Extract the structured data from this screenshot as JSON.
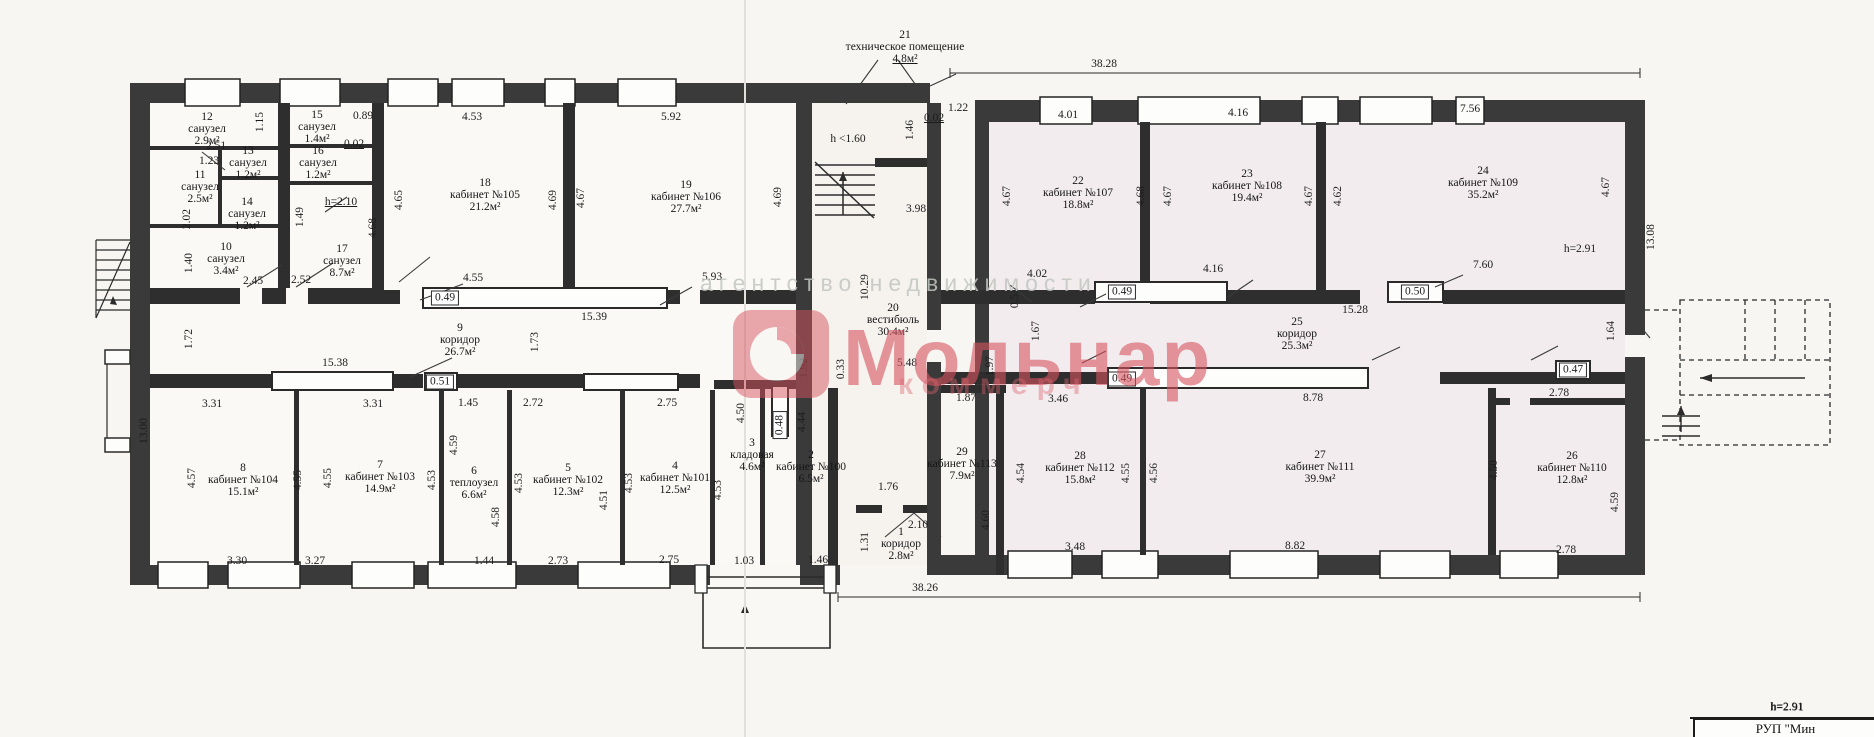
{
  "watermark": {
    "brand": "Мольнар",
    "tagline": "агентство недвижимости",
    "sub": "коммерч",
    "accent_color": "#d85560",
    "gray_color": "#c2c6c1"
  },
  "title_block": {
    "height_note": "h=2.91",
    "org": "РУП \"Мин"
  },
  "rooms": [
    {
      "n": "1",
      "name": "коридор",
      "area": "2.8м²",
      "x": 901,
      "y": 544
    },
    {
      "n": "2",
      "name": "кабинет №100",
      "area": "6.5м²",
      "x": 811,
      "y": 467
    },
    {
      "n": "3",
      "name": "кладовая",
      "area": "4.6м²",
      "x": 752,
      "y": 455
    },
    {
      "n": "4",
      "name": "кабинет №101",
      "area": "12.5м²",
      "x": 675,
      "y": 478
    },
    {
      "n": "5",
      "name": "кабинет №102",
      "area": "12.3м²",
      "x": 568,
      "y": 480
    },
    {
      "n": "6",
      "name": "теплоузел",
      "area": "6.6м²",
      "x": 474,
      "y": 483
    },
    {
      "n": "7",
      "name": "кабинет №103",
      "area": "14.9м²",
      "x": 380,
      "y": 477
    },
    {
      "n": "8",
      "name": "кабинет №104",
      "area": "15.1м²",
      "x": 243,
      "y": 480
    },
    {
      "n": "9",
      "name": "коридор",
      "area": "26.7м²",
      "x": 460,
      "y": 340
    },
    {
      "n": "10",
      "name": "санузел",
      "area": "3.4м²",
      "x": 226,
      "y": 259
    },
    {
      "n": "11",
      "name": "санузел",
      "area": "2.5м²",
      "x": 200,
      "y": 187
    },
    {
      "n": "12",
      "name": "санузел",
      "area": "2.9м²",
      "x": 207,
      "y": 129
    },
    {
      "n": "13",
      "name": "санузел",
      "area": "1.2м²",
      "x": 248,
      "y": 163
    },
    {
      "n": "14",
      "name": "санузел",
      "area": "1.2м²",
      "x": 247,
      "y": 214
    },
    {
      "n": "15",
      "name": "санузел",
      "area": "1.4м²",
      "x": 317,
      "y": 127
    },
    {
      "n": "16",
      "name": "санузел",
      "area": "1.2м²",
      "x": 318,
      "y": 163
    },
    {
      "n": "17",
      "name": "санузел",
      "area": "8.7м²",
      "x": 342,
      "y": 261
    },
    {
      "n": "18",
      "name": "кабинет №105",
      "area": "21.2м²",
      "x": 485,
      "y": 195
    },
    {
      "n": "19",
      "name": "кабинет №106",
      "area": "27.7м²",
      "x": 686,
      "y": 197
    },
    {
      "n": "20",
      "name": "вестибюль",
      "area": "30.4м²",
      "x": 893,
      "y": 320
    },
    {
      "n": "21",
      "name": "техническое помещение",
      "area": "4.8м²",
      "x": 905,
      "y": 47,
      "u": true
    },
    {
      "n": "22",
      "name": "кабинет №107",
      "area": "18.8м²",
      "x": 1078,
      "y": 193
    },
    {
      "n": "23",
      "name": "кабинет №108",
      "area": "19.4м²",
      "x": 1247,
      "y": 186
    },
    {
      "n": "24",
      "name": "кабинет №109",
      "area": "35.2м²",
      "x": 1483,
      "y": 183
    },
    {
      "n": "25",
      "name": "коридор",
      "area": "25.3м²",
      "x": 1297,
      "y": 334
    },
    {
      "n": "26",
      "name": "кабинет №110",
      "area": "12.8м²",
      "x": 1572,
      "y": 468
    },
    {
      "n": "27",
      "name": "кабинет №111",
      "area": "39.9м²",
      "x": 1320,
      "y": 467
    },
    {
      "n": "28",
      "name": "кабинет №112",
      "area": "15.8м²",
      "x": 1080,
      "y": 468
    },
    {
      "n": "29",
      "name": "кабинет №113",
      "area": "7.9м²",
      "x": 962,
      "y": 464
    }
  ],
  "dims": [
    {
      "t": "2.51",
      "x": 216,
      "y": 146
    },
    {
      "t": "1.23",
      "x": 209,
      "y": 161
    },
    {
      "t": "2.45",
      "x": 253,
      "y": 281
    },
    {
      "t": "2.52",
      "x": 301,
      "y": 280
    },
    {
      "t": "0.89",
      "x": 363,
      "y": 116
    },
    {
      "t": "0.02",
      "x": 354,
      "y": 144,
      "u": true
    },
    {
      "t": "h=2.10",
      "x": 341,
      "y": 202,
      "u": true
    },
    {
      "t": "4.53",
      "x": 472,
      "y": 117
    },
    {
      "t": "4.55",
      "x": 473,
      "y": 278
    },
    {
      "t": "0.49",
      "x": 445,
      "y": 298,
      "box": true
    },
    {
      "t": "15.39",
      "x": 594,
      "y": 317
    },
    {
      "t": "5.92",
      "x": 671,
      "y": 117
    },
    {
      "t": "5.93",
      "x": 712,
      "y": 277
    },
    {
      "t": "h <1.60",
      "x": 848,
      "y": 139
    },
    {
      "t": "0.02",
      "x": 934,
      "y": 118,
      "u": true
    },
    {
      "t": "1.22",
      "x": 958,
      "y": 108
    },
    {
      "t": "3.98",
      "x": 916,
      "y": 209
    },
    {
      "t": "38.28",
      "x": 1104,
      "y": 64
    },
    {
      "t": "4.01",
      "x": 1068,
      "y": 115
    },
    {
      "t": "4.16",
      "x": 1238,
      "y": 113
    },
    {
      "t": "7.56",
      "x": 1470,
      "y": 109
    },
    {
      "t": "h=2.91",
      "x": 1580,
      "y": 249
    },
    {
      "t": "7.60",
      "x": 1483,
      "y": 265
    },
    {
      "t": "0.50",
      "x": 1415,
      "y": 292,
      "box": true
    },
    {
      "t": "4.02",
      "x": 1037,
      "y": 274
    },
    {
      "t": "15.28",
      "x": 1355,
      "y": 310
    },
    {
      "t": "4.16",
      "x": 1213,
      "y": 269
    },
    {
      "t": "0.49",
      "x": 1122,
      "y": 292,
      "box": true
    },
    {
      "t": "15.38",
      "x": 335,
      "y": 363
    },
    {
      "t": "0.51",
      "x": 440,
      "y": 382,
      "box": true
    },
    {
      "t": "3.31",
      "x": 212,
      "y": 404
    },
    {
      "t": "3.31",
      "x": 373,
      "y": 404
    },
    {
      "t": "1.45",
      "x": 468,
      "y": 403
    },
    {
      "t": "2.72",
      "x": 533,
      "y": 403
    },
    {
      "t": "2.75",
      "x": 667,
      "y": 403
    },
    {
      "t": "3.30",
      "x": 237,
      "y": 561
    },
    {
      "t": "3.27",
      "x": 315,
      "y": 561
    },
    {
      "t": "1.44",
      "x": 484,
      "y": 561
    },
    {
      "t": "2.73",
      "x": 558,
      "y": 561
    },
    {
      "t": "2.75",
      "x": 669,
      "y": 560
    },
    {
      "t": "1.03",
      "x": 744,
      "y": 561
    },
    {
      "t": "1.46",
      "x": 818,
      "y": 560
    },
    {
      "t": "1.76",
      "x": 888,
      "y": 487
    },
    {
      "t": "2.10",
      "x": 918,
      "y": 525
    },
    {
      "t": "5.48",
      "x": 907,
      "y": 363
    },
    {
      "t": "1.87",
      "x": 966,
      "y": 398
    },
    {
      "t": "3.46",
      "x": 1058,
      "y": 399
    },
    {
      "t": "0.49",
      "x": 1122,
      "y": 379,
      "box": true
    },
    {
      "t": "8.78",
      "x": 1313,
      "y": 398
    },
    {
      "t": "3.48",
      "x": 1075,
      "y": 547
    },
    {
      "t": "8.82",
      "x": 1295,
      "y": 546
    },
    {
      "t": "2.78",
      "x": 1559,
      "y": 393
    },
    {
      "t": "0.47",
      "x": 1573,
      "y": 370,
      "box": true
    },
    {
      "t": "2.78",
      "x": 1566,
      "y": 550
    },
    {
      "t": "38.26",
      "x": 925,
      "y": 588
    },
    {
      "t": "h=2.91",
      "x": 1787,
      "y": 707
    },
    {
      "t": "1.15",
      "x": 260,
      "y": 122,
      "v": true
    },
    {
      "t": "2.02",
      "x": 187,
      "y": 219,
      "v": true
    },
    {
      "t": "1.49",
      "x": 300,
      "y": 217,
      "v": true
    },
    {
      "t": "1.40",
      "x": 189,
      "y": 263,
      "v": true
    },
    {
      "t": "4.68",
      "x": 373,
      "y": 228,
      "v": true
    },
    {
      "t": "4.65",
      "x": 399,
      "y": 200,
      "v": true
    },
    {
      "t": "4.69",
      "x": 553,
      "y": 200,
      "v": true
    },
    {
      "t": "4.67",
      "x": 581,
      "y": 198,
      "v": true
    },
    {
      "t": "4.69",
      "x": 778,
      "y": 197,
      "v": true
    },
    {
      "t": "1.46",
      "x": 910,
      "y": 130,
      "v": true
    },
    {
      "t": "10.29",
      "x": 865,
      "y": 287,
      "v": true
    },
    {
      "t": "1.72",
      "x": 189,
      "y": 339,
      "v": true
    },
    {
      "t": "13.00",
      "x": 144,
      "y": 431,
      "v": true
    },
    {
      "t": "1.73",
      "x": 535,
      "y": 342,
      "v": true
    },
    {
      "t": "4.57",
      "x": 192,
      "y": 478,
      "v": true
    },
    {
      "t": "4.55",
      "x": 298,
      "y": 480,
      "v": true
    },
    {
      "t": "4.55",
      "x": 328,
      "y": 478,
      "v": true
    },
    {
      "t": "4.53",
      "x": 432,
      "y": 480,
      "v": true
    },
    {
      "t": "4.59",
      "x": 454,
      "y": 445,
      "v": true
    },
    {
      "t": "4.53",
      "x": 519,
      "y": 483,
      "v": true
    },
    {
      "t": "4.51",
      "x": 604,
      "y": 500,
      "v": true
    },
    {
      "t": "4.53",
      "x": 629,
      "y": 483,
      "v": true
    },
    {
      "t": "4.58",
      "x": 496,
      "y": 517,
      "v": true
    },
    {
      "t": "4.50",
      "x": 741,
      "y": 413,
      "v": true
    },
    {
      "t": "0.48",
      "x": 780,
      "y": 425,
      "v": true,
      "box": true
    },
    {
      "t": "4.44",
      "x": 802,
      "y": 422,
      "v": true
    },
    {
      "t": "4.53",
      "x": 718,
      "y": 490,
      "v": true
    },
    {
      "t": "1.31",
      "x": 865,
      "y": 542,
      "v": true
    },
    {
      "t": "1.92",
      "x": 804,
      "y": 368,
      "v": true
    },
    {
      "t": "0.33",
      "x": 841,
      "y": 369,
      "v": true
    },
    {
      "t": "1.97",
      "x": 990,
      "y": 366,
      "v": true
    },
    {
      "t": "1.67",
      "x": 1036,
      "y": 331,
      "v": true
    },
    {
      "t": "0.51",
      "x": 1015,
      "y": 298,
      "v": true
    },
    {
      "t": "4.67",
      "x": 1007,
      "y": 196,
      "v": true
    },
    {
      "t": "4.68",
      "x": 1141,
      "y": 196,
      "v": true
    },
    {
      "t": "4.67",
      "x": 1168,
      "y": 196,
      "v": true
    },
    {
      "t": "4.67",
      "x": 1309,
      "y": 196,
      "v": true
    },
    {
      "t": "4.62",
      "x": 1338,
      "y": 196,
      "v": true
    },
    {
      "t": "4.67",
      "x": 1606,
      "y": 187,
      "v": true
    },
    {
      "t": "13.08",
      "x": 1651,
      "y": 237,
      "v": true
    },
    {
      "t": "4.54",
      "x": 1021,
      "y": 473,
      "v": true
    },
    {
      "t": "4.55",
      "x": 1126,
      "y": 473,
      "v": true
    },
    {
      "t": "4.56",
      "x": 1154,
      "y": 473,
      "v": true
    },
    {
      "t": "4.60",
      "x": 986,
      "y": 520,
      "v": true
    },
    {
      "t": "4.50",
      "x": 1494,
      "y": 470,
      "v": true
    },
    {
      "t": "4.59",
      "x": 1615,
      "y": 502,
      "v": true
    },
    {
      "t": "1.64",
      "x": 1611,
      "y": 331,
      "v": true
    }
  ]
}
